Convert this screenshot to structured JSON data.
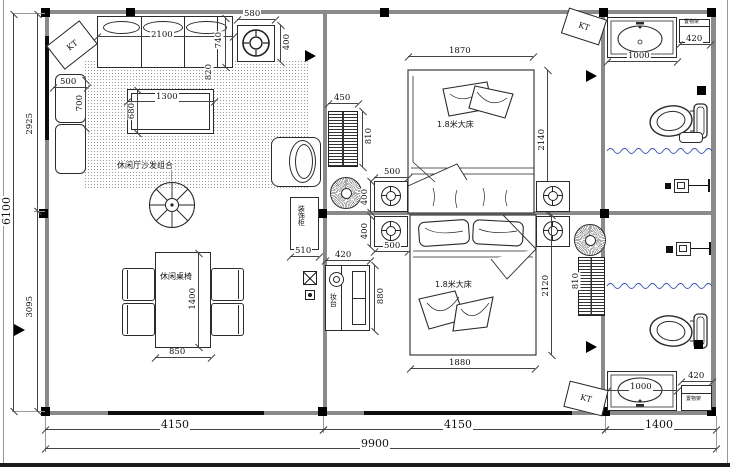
{
  "labels": {
    "sofa_group": "休闲厅沙发组合",
    "dining_set": "休闲桌椅",
    "deco_cabinet": "装饰柜",
    "dressing_table": "妆台",
    "bed1": "1.8米大床",
    "bed2": "1.8米大床",
    "shelf_top": "置物架",
    "shelf_bottom": "置物架",
    "kt": "KT"
  },
  "dimensions": {
    "overall_width": "9900",
    "overall_height": "6100",
    "bottom_living": "4150",
    "bottom_bedroom": "4150",
    "bottom_bath": "1400",
    "left_upper": "2925",
    "left_lower": "3095",
    "sofa_width": "2100",
    "sofa_depth": "740",
    "sofa_offset": "820",
    "armchair_width": "500",
    "armchair_depth": "700",
    "coffee_table_width": "1300",
    "coffee_table_depth": "680",
    "ceiling_unit_width": "580",
    "ceiling_unit_depth": "400",
    "dining_width": "850",
    "dining_length": "1400",
    "cabinet_width": "510",
    "radiator_width": "450",
    "radiator_length": "810",
    "bed1_width": "1870",
    "bed1_length": "2140",
    "bed2_width": "1880",
    "bed2_length": "2120",
    "nightstand_width": "500",
    "nightstand_depth": "400",
    "dresser_width": "420",
    "dresser_length": "880",
    "sink_width": "1000",
    "shelf_width": "420"
  }
}
